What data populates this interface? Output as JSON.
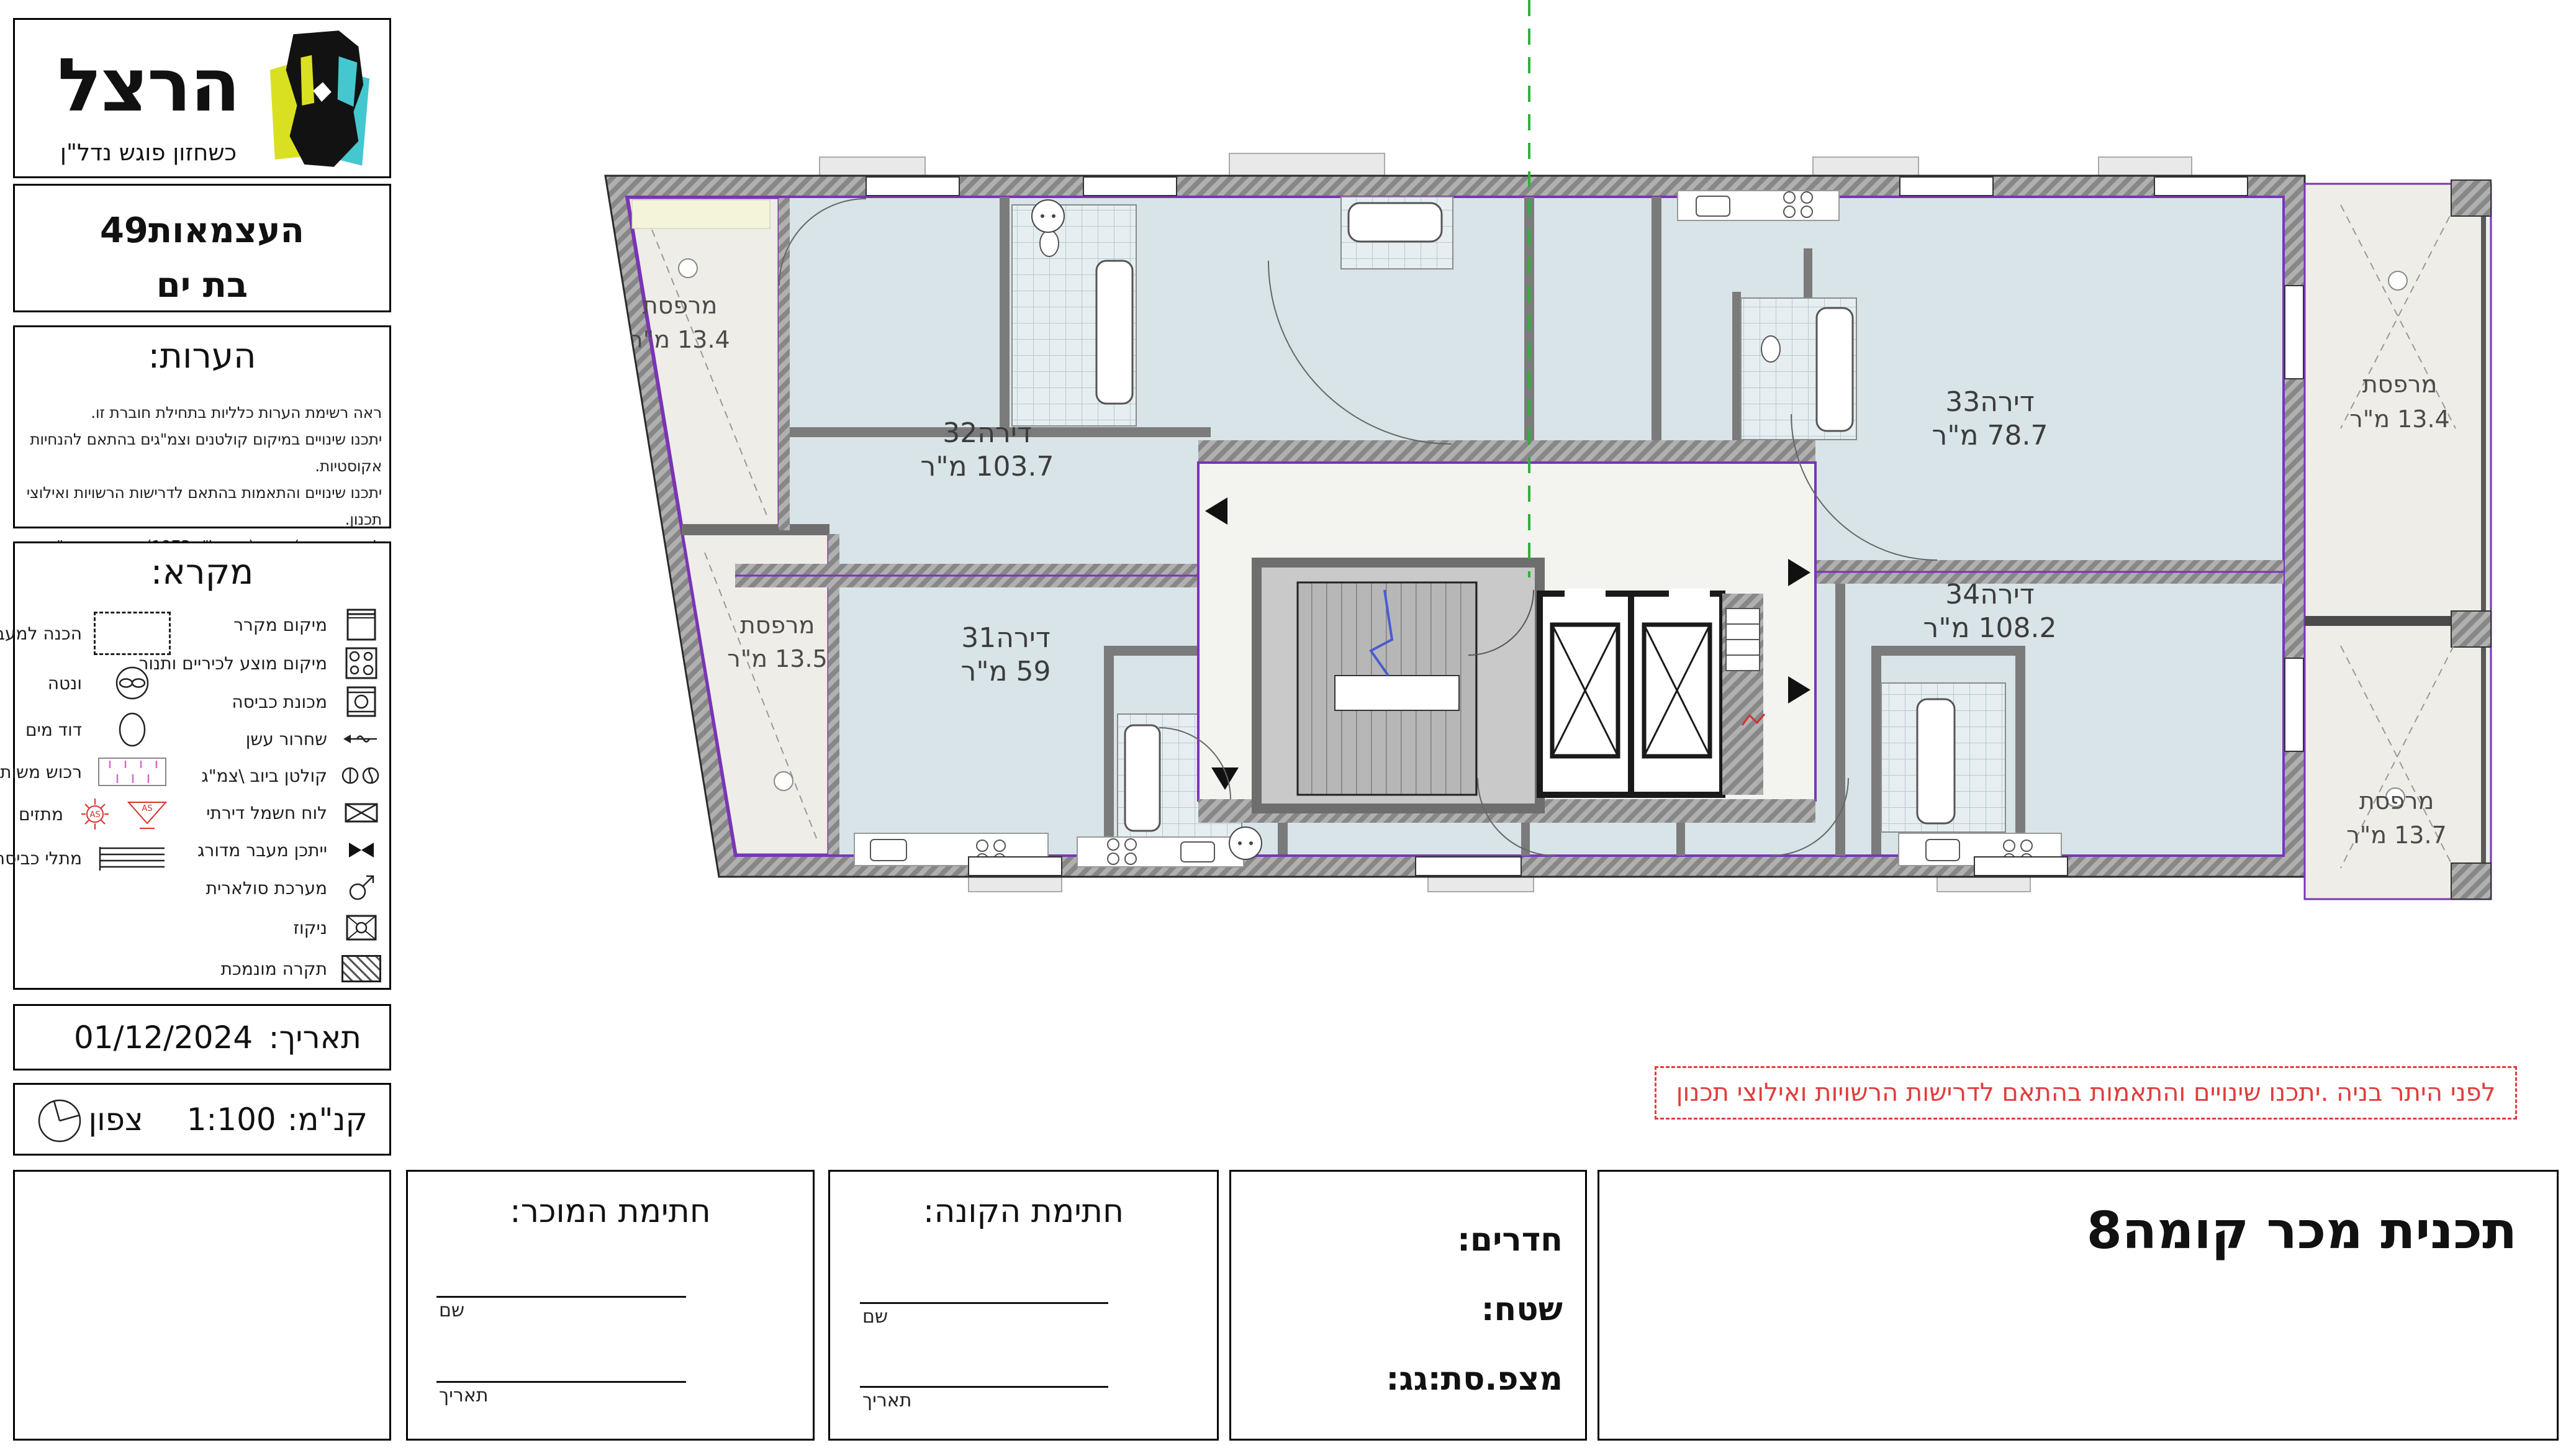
{
  "branding": {
    "logo_text": "הרצל",
    "logo_tagline": "כשחזון פוגש נדל\"ן",
    "project_line1": "העצמאות49",
    "project_line2": "בת ים"
  },
  "notes": {
    "title": "הערות:",
    "line1": "ראה רשימת הערות כלליות בתחילת חוברת זו.",
    "line2": "יתכנו שינויים במיקום קולטנים וצמ\"גים בהתאם להנחיות אקוסטיות.",
    "line3": "יתכנו שינויים והתאמות בהתאם לדרישות הרשויות ואילוצי תכנון.",
    "line4": "לפי חוק מכר)דירות (התשל\"ג-1973) תיקון התשס\" ח2008("
  },
  "legend": {
    "title": "מקרא:",
    "sprinkler_code": "AS",
    "right_items": [
      {
        "label": "מיקום מקרר"
      },
      {
        "label": "מיקום מוצע לכיריים ותנור"
      },
      {
        "label": "מכונת כביסה"
      },
      {
        "label": "שחרור עשן"
      },
      {
        "label": "קולטן ביוב \\צמ\"ג"
      },
      {
        "label": "לוח חשמל דירתי"
      },
      {
        "label": "ייתכן מעבר מדורג"
      },
      {
        "label": "מערכת סולארית"
      },
      {
        "label": "ניקוז"
      },
      {
        "label": "תקרה מונמכת"
      }
    ],
    "left_items": [
      {
        "label": "הכנה למעבה"
      },
      {
        "label": "ונטה"
      },
      {
        "label": "דוד מים"
      },
      {
        "label": "רכוש משותף"
      },
      {
        "label": "מתזים"
      },
      {
        "label": "מתלי כביסה"
      }
    ]
  },
  "date_row": {
    "label": "תאריך:",
    "value": "01/12/2024"
  },
  "scale_row": {
    "label": "קנ\"מ:",
    "value": "1:100",
    "north_label": "צפון"
  },
  "warning": {
    "text": "לפני היתר בניה .יתכנו שינויים והתאמות בהתאם לדרישות הרשויות ואילוצי תכנון"
  },
  "plan": {
    "apartments": [
      {
        "name": "דירה32",
        "area": "103.7 מ\"ר"
      },
      {
        "name": "דירה33",
        "area": "78.7 מ\"ר"
      },
      {
        "name": "דירה31",
        "area": "59 מ\"ר"
      },
      {
        "name": "דירה34",
        "area": "108.2 מ\"ר"
      }
    ],
    "balconies": [
      {
        "name": "מרפסת",
        "area": "13.4 מ\"ר"
      },
      {
        "name": "מרפסת",
        "area": "13.5 מ\"ר"
      },
      {
        "name": "מרפסת",
        "area": "13.4 מ\"ר"
      },
      {
        "name": "מרפסת",
        "area": "13.7 מ\"ר"
      }
    ]
  },
  "signatures": {
    "seller": {
      "title": "חתימת המוכר:",
      "name_label": "שם",
      "date_label": "תאריך"
    },
    "buyer": {
      "title": "חתימת הקונה:",
      "name_label": "שם",
      "date_label": "תאריך"
    },
    "details": {
      "rooms_label": "חדרים:",
      "area_label": "שטח:",
      "balcony_roof_label": "מצפ.סת:גג:"
    },
    "main_title": "תכנית מכר קומה8"
  }
}
